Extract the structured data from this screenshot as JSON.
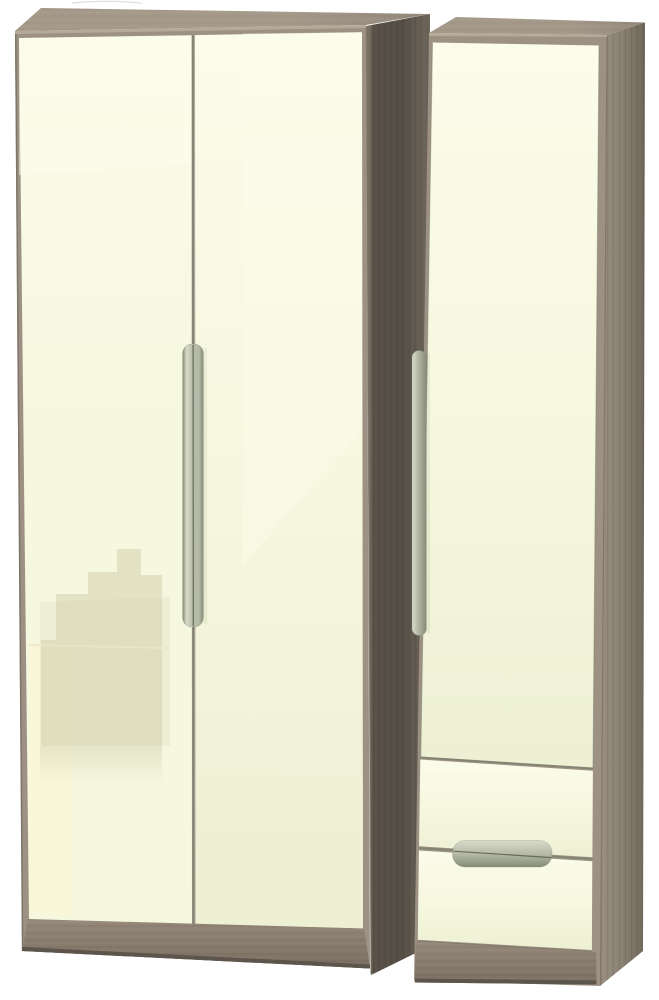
{
  "image": {
    "kind": "furniture-product-photo",
    "background": "plain-white",
    "items": [
      {
        "name": "double-wardrobe",
        "features": [
          "two-gloss-doors",
          "twin-vertical-handles",
          "wood-top",
          "wood-plinth",
          "glossy-skyline-reflection"
        ]
      },
      {
        "name": "single-wardrobe",
        "features": [
          "one-gloss-door",
          "vertical-edge-handle",
          "two-drawers",
          "horizontal-drawer-handle",
          "wood-top",
          "wood-plinth"
        ]
      }
    ],
    "finish": {
      "fronts": "high-gloss-cream",
      "carcass": "toned-wood"
    }
  },
  "colors": {
    "background": "#ffffff",
    "cream": "#f5f7de",
    "cream_bright": "#fbfcea",
    "cream_shade": "#edf0d3",
    "wood_top": "#a59a8a",
    "wood_top_dark": "#93887a",
    "wood_lip": "#b5a998",
    "wood_edge_shadow": "#756c5f",
    "frame": "#9c9183",
    "frame_edge": "#7b7366",
    "plinth_light": "#96897a",
    "plinth_dark": "#7a6f62",
    "plinth_bottom": "#5d554b",
    "side_left_edge": "#8d8273",
    "side_left_dark": "#585046",
    "side_left_mid": "#544d44",
    "side_left_back": "#6e665b",
    "side_right_front": "#998e80",
    "side_right_mid": "#8a8073",
    "side_right_back": "#6f665a",
    "handle_light": "#d8dbc9",
    "handle_base": "#b6baa8",
    "handle_shade": "#868c77",
    "handle_seam": "#676b5b",
    "gap_line": "#7e8271",
    "reflection": "#d5d2b1",
    "reflection_glow": "#fbf7d6",
    "artifact": "#dcdcdc"
  }
}
